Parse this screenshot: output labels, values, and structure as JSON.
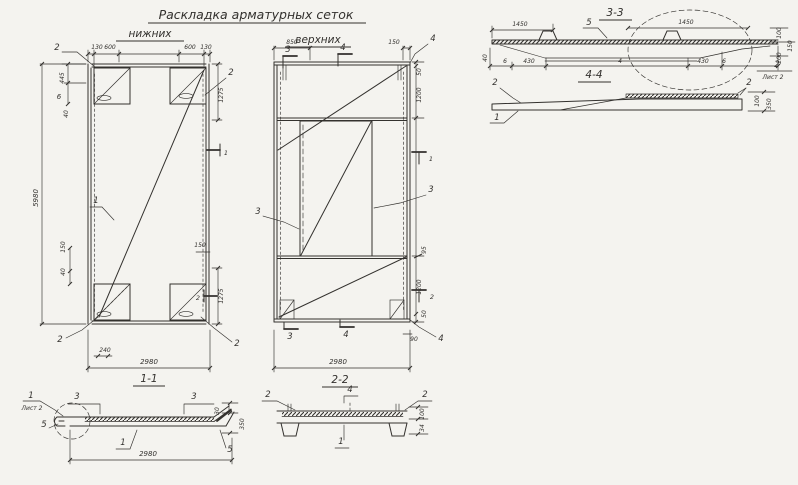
{
  "colors": {
    "paper": "#f4f3ef",
    "ink": "#33312e"
  },
  "title": {
    "main": "Раскладка арматурных сеток",
    "left": "нижних",
    "right": "верхних"
  },
  "plan_lower": {
    "label": "1-1",
    "dims": {
      "top": [
        "130",
        "600",
        "600",
        "130"
      ],
      "left": [
        "445",
        "6",
        "40",
        "5980",
        "150",
        "40"
      ],
      "right": [
        "1275",
        "150",
        "1275"
      ],
      "bottom": [
        "240",
        "2980"
      ]
    },
    "callouts": {
      "tl": "2",
      "center": "1",
      "tr": "2",
      "bl": "2",
      "br": "2"
    },
    "flags": {
      "t1": "1",
      "t2": "2"
    }
  },
  "plan_upper": {
    "label": "2-2",
    "dims": {
      "top": [
        "850",
        "150"
      ],
      "right": [
        "50",
        "1200",
        "95",
        "1200",
        "50",
        "90"
      ],
      "bottom": [
        "2980"
      ]
    },
    "callouts": {
      "tr": "4",
      "left": "3",
      "right": "3",
      "br": "4"
    },
    "flags": {
      "top3": "3",
      "top4": "4",
      "bot3": "3",
      "bot4": "4",
      "t1": "1",
      "t2": "2"
    }
  },
  "section_33": {
    "label": "3-3",
    "dims": {
      "top_left": "1450",
      "top_right": "1450",
      "right": [
        "100",
        "150",
        "200"
      ],
      "bottom": [
        "40",
        "6",
        "430",
        "4",
        "430",
        "6"
      ]
    },
    "callouts": {
      "c5": "5",
      "c2": "2"
    },
    "sheet_ref": "Лист 2"
  },
  "section_44": {
    "label": "4-4",
    "dims": {
      "right": [
        "100",
        "350"
      ]
    },
    "callouts": {
      "left2": "2",
      "left1": "1",
      "right2": "2"
    }
  },
  "section_11": {
    "dims": {
      "right": [
        "30",
        "350"
      ],
      "bottom": "2980"
    },
    "callouts": {
      "c1_top": "1",
      "sheet_ref": "Лист 2",
      "f3a": "3",
      "f3b": "3",
      "c5_left": "5",
      "c5_right": "5",
      "c1_mid": "1"
    }
  },
  "section_22": {
    "dims": {
      "right": [
        "100",
        "34"
      ]
    },
    "callouts": {
      "left2": "2",
      "top4": "4",
      "right2": "2",
      "bottom1": "1"
    }
  }
}
